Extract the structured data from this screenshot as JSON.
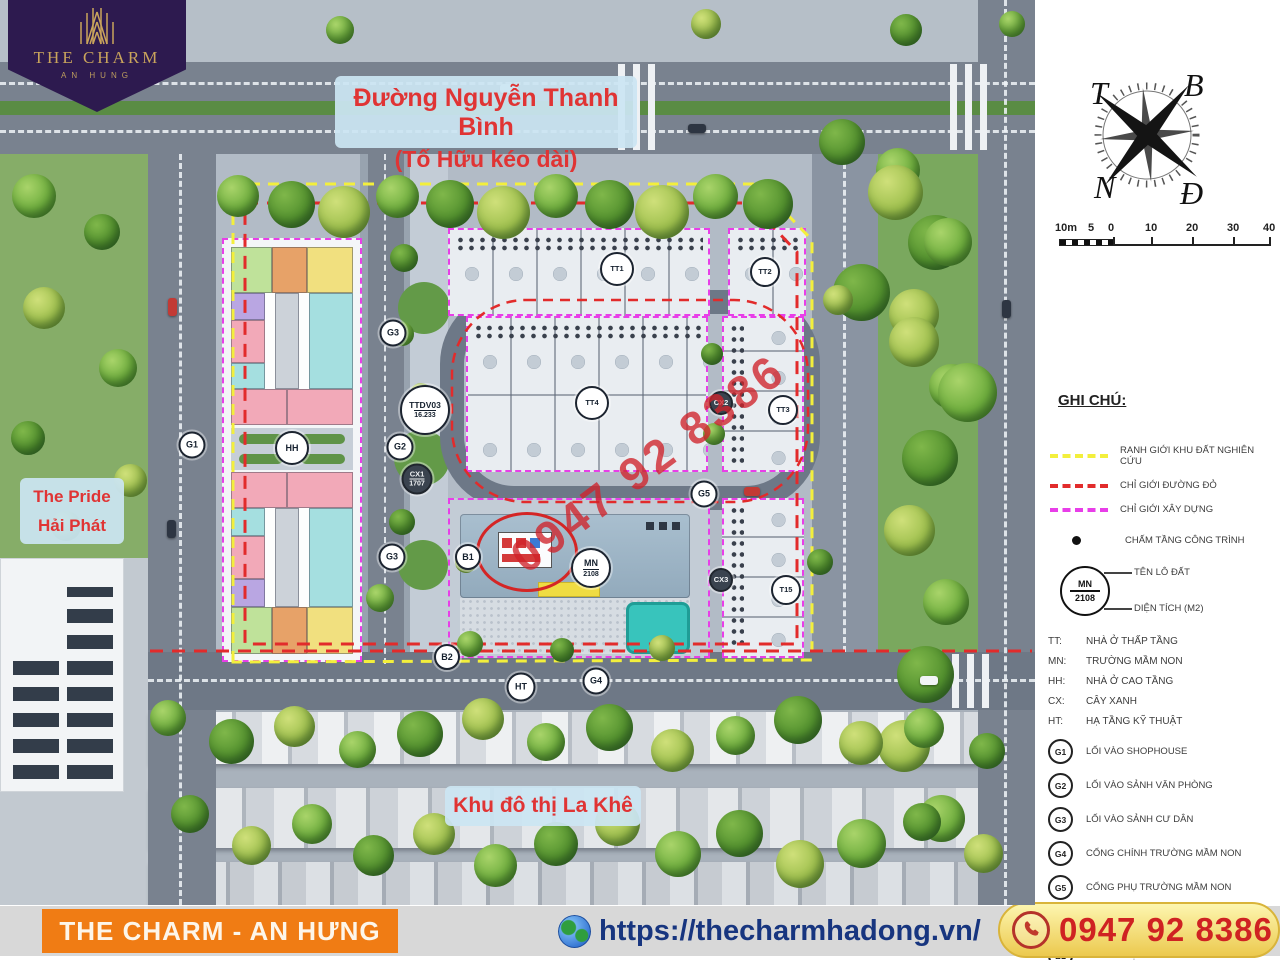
{
  "logo": {
    "title": "THE CHARM",
    "subtitle": "AN HUNG"
  },
  "labels": {
    "road_sign_line1": "Đường Nguyễn Thanh Bình",
    "road_sign_line2": "(Tố Hữu kéo dài)",
    "pride_line1": "The Pride",
    "pride_line2": "Hải Phát",
    "lakhe": "Khu đô thị La Khê",
    "watermark": "0947 92 8386"
  },
  "compass": {
    "west": "T",
    "north": "B",
    "south": "N",
    "east": "Đ"
  },
  "scalebar": {
    "ticks": [
      "10m",
      "5",
      "0",
      "10",
      "20",
      "30",
      "40"
    ]
  },
  "legend": {
    "heading": "GHI CHÚ:",
    "boundary_lines": [
      {
        "color": "#f3ef3c",
        "label": "RANH GIỚI KHU ĐẤT NGHIÊN CỨU"
      },
      {
        "color": "#e22b2b",
        "label": "CHỈ GIỚI ĐƯỜNG ĐỎ"
      },
      {
        "color": "#e83ee8",
        "label": "CHỈ GIỚI XÂY DỰNG"
      }
    ],
    "dot_item": {
      "label": "CHẤM TẦNG CÔNG TRÌNH"
    },
    "lot_symbol": {
      "code": "MN",
      "area": "2108",
      "name_label": "TÊN LÔ ĐẤT",
      "area_label": "DIỆN TÍCH (M2)"
    },
    "abbreviations": [
      {
        "code": "TT:",
        "label": "NHÀ Ở THẤP TẦNG"
      },
      {
        "code": "MN:",
        "label": "TRƯỜNG MẦM NON"
      },
      {
        "code": "HH:",
        "label": "NHÀ Ở CAO TẦNG"
      },
      {
        "code": "CX:",
        "label": "CÂY XANH"
      },
      {
        "code": "HT:",
        "label": "HẠ TẦNG KỸ THUẬT"
      }
    ],
    "gates": [
      {
        "code": "G1",
        "label": "LỐI VÀO SHOPHOUSE"
      },
      {
        "code": "G2",
        "label": "LỐI VÀO SẢNH VĂN PHÒNG"
      },
      {
        "code": "G3",
        "label": "LỐI VÀO SẢNH CƯ DÂN"
      },
      {
        "code": "G4",
        "label": "CỔNG CHÍNH TRƯỜNG MẦM NON"
      },
      {
        "code": "G5",
        "label": "CỔNG PHỤ TRƯỜNG MẦM NON"
      },
      {
        "code": "B1",
        "label": "BỂ NƯỚC SINH HOẠT, PCCC ĐẶT NGẦM"
      },
      {
        "code": "B2",
        "label": "BỂ DẦU ĐẶT NGẦM"
      }
    ]
  },
  "map_markers": [
    {
      "code": "G1",
      "x": 192,
      "y": 445,
      "d": 23
    },
    {
      "code": "G3",
      "x": 393,
      "y": 333,
      "d": 23
    },
    {
      "code": "TTDV03",
      "sub": "16.233",
      "x": 425,
      "y": 410,
      "d": 46
    },
    {
      "code": "G2",
      "x": 400,
      "y": 447,
      "d": 23
    },
    {
      "code": "CX1",
      "sub": "1707",
      "x": 417,
      "y": 479,
      "d": 27,
      "dark": true
    },
    {
      "code": "G3",
      "x": 392,
      "y": 557,
      "d": 23
    },
    {
      "code": "B1",
      "x": 468,
      "y": 557,
      "d": 22
    },
    {
      "code": "B2",
      "x": 447,
      "y": 657,
      "d": 22
    },
    {
      "code": "HT",
      "x": 521,
      "y": 687,
      "d": 25
    },
    {
      "code": "G4",
      "x": 596,
      "y": 681,
      "d": 23
    },
    {
      "code": "G5",
      "x": 704,
      "y": 494,
      "d": 23
    },
    {
      "code": "HH",
      "x": 292,
      "y": 448,
      "d": 30
    },
    {
      "code": "TT1",
      "x": 617,
      "y": 269,
      "d": 30
    },
    {
      "code": "TT2",
      "x": 765,
      "y": 272,
      "d": 26
    },
    {
      "code": "TT4",
      "x": 592,
      "y": 403,
      "d": 30
    },
    {
      "code": "TT3",
      "x": 783,
      "y": 410,
      "d": 26
    },
    {
      "code": "MN",
      "sub": "2108",
      "x": 591,
      "y": 568,
      "d": 36
    },
    {
      "code": "T15",
      "x": 786,
      "y": 590,
      "d": 26
    },
    {
      "code": "CX2",
      "x": 721,
      "y": 403,
      "d": 20,
      "dark": true
    },
    {
      "code": "CX3",
      "x": 721,
      "y": 580,
      "d": 20,
      "dark": true
    }
  ],
  "footer": {
    "title": "THE CHARM - AN HƯNG",
    "url": "https://thecharmhadong.vn/",
    "phone": "0947 92 8386"
  },
  "colors": {
    "accent_orange": "#f07c14",
    "phone_red": "#cf2222",
    "url_blue": "#17357f",
    "banner_purple": "#2d1a4f",
    "gold": "#c9a45c",
    "boundary_yellow": "#f3ef3c",
    "boundary_red": "#e22b2b",
    "boundary_magenta": "#e83ee8"
  }
}
